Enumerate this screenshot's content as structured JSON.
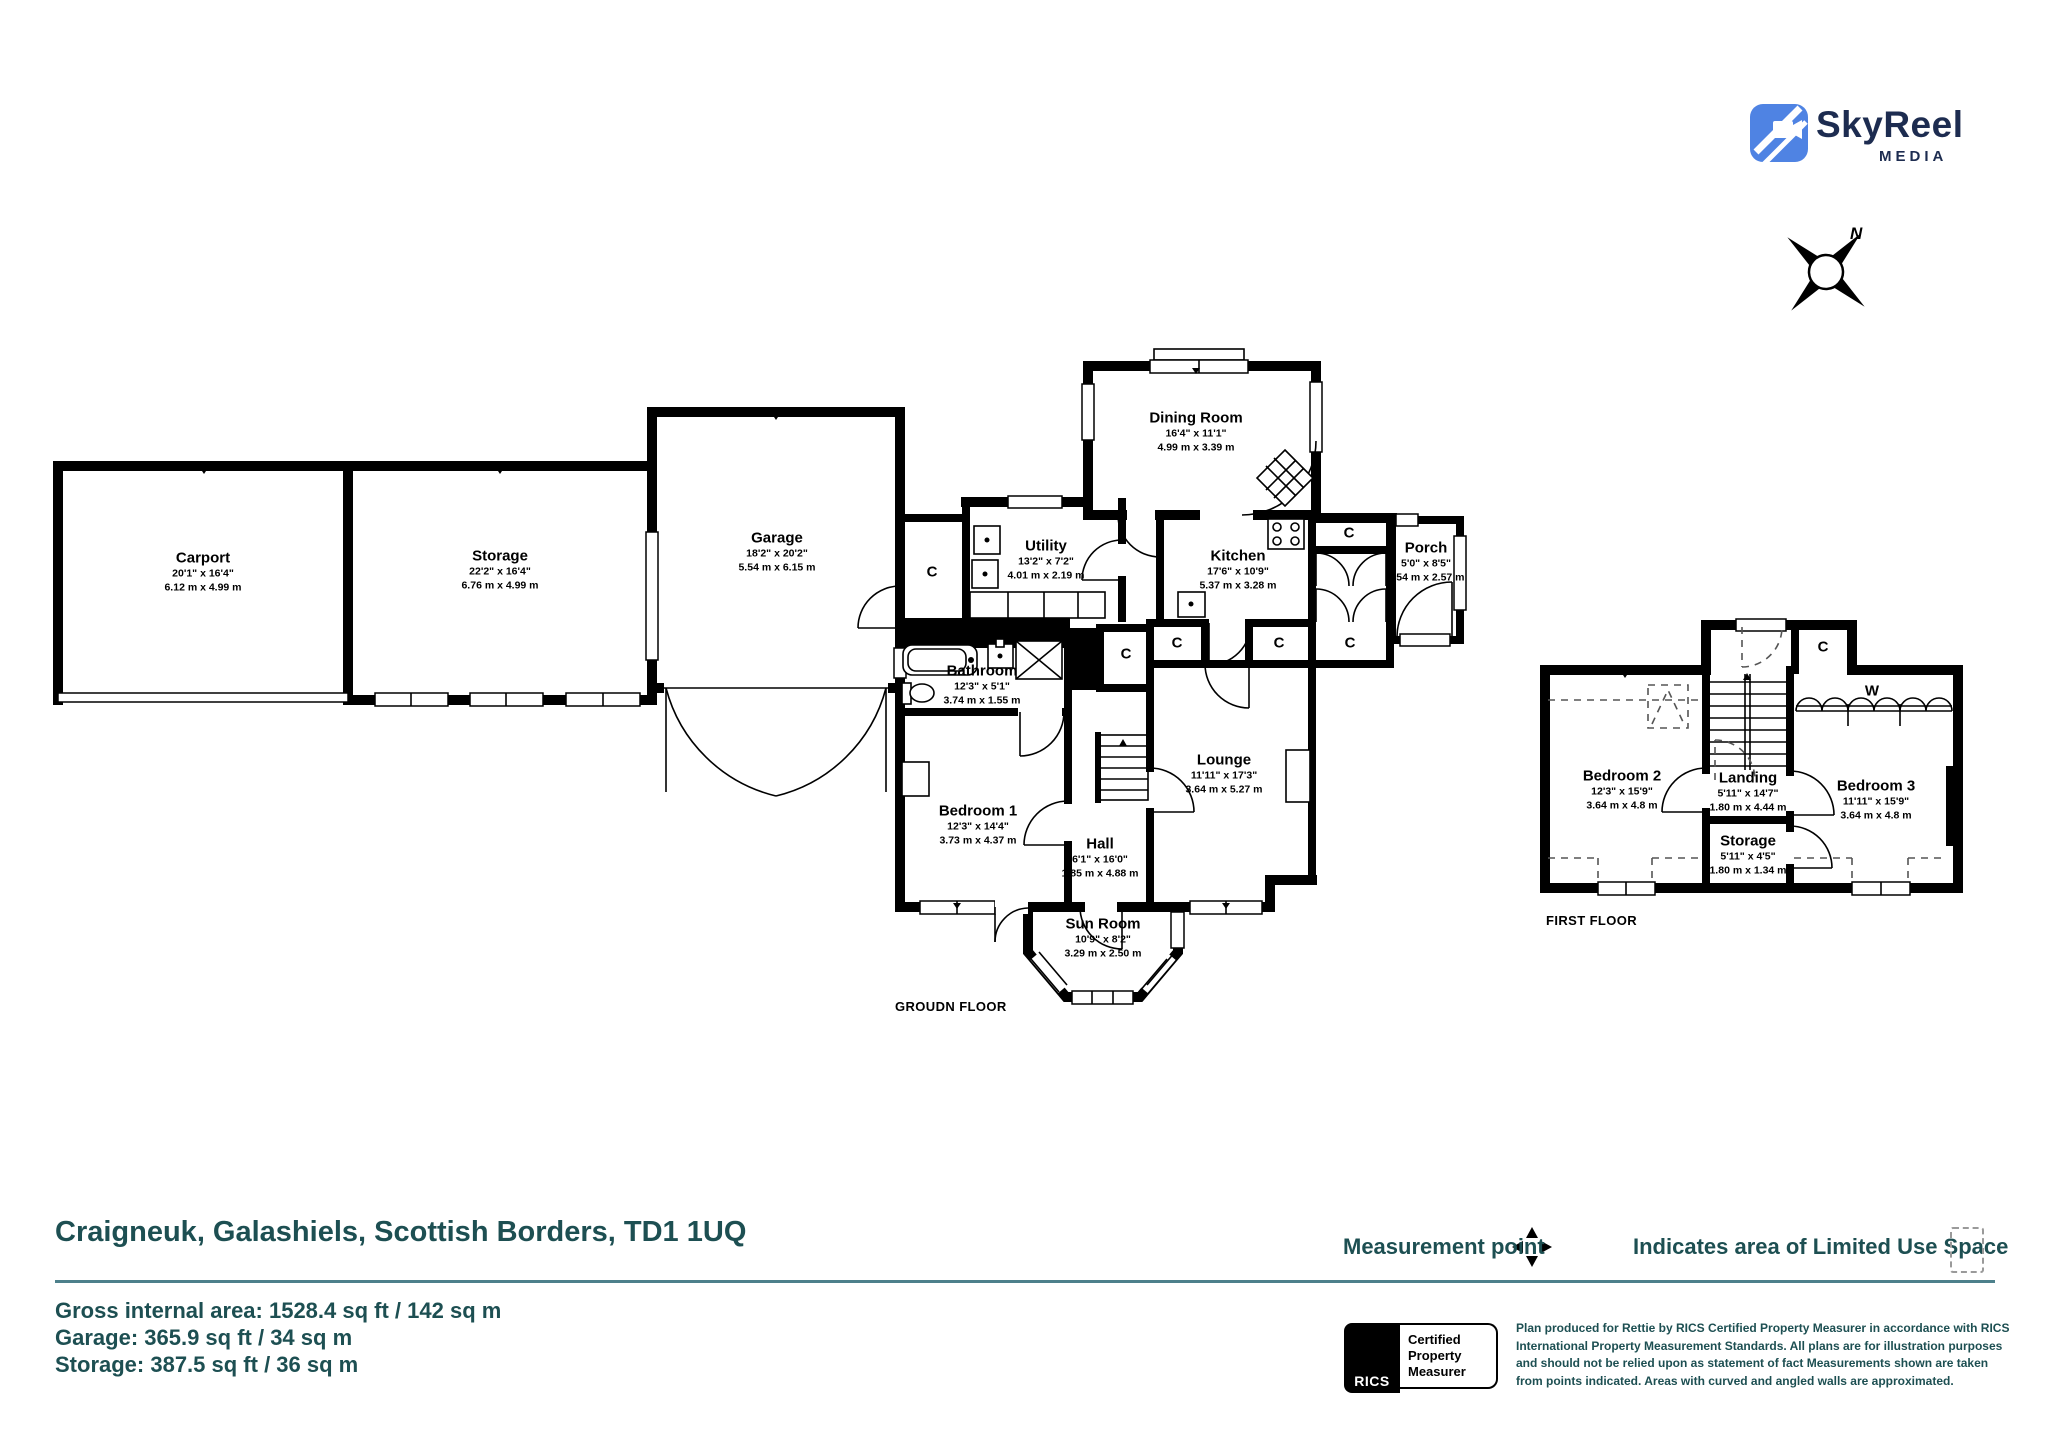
{
  "branding": {
    "logo_text": "SkyReel",
    "logo_subtext": "MEDIA",
    "logo_blue": "#4f83e3",
    "logo_navy": "#1d2c50"
  },
  "compass": {
    "north_label": "N"
  },
  "labels": {
    "closet": "C",
    "wardrobe": "W"
  },
  "floors": {
    "ground": {
      "title": "GROUDN FLOOR",
      "rooms": [
        {
          "name": "Carport",
          "imperial": "20'1\" x 16'4\"",
          "metric": "6.12 m x 4.99 m"
        },
        {
          "name": "Storage",
          "imperial": "22'2\" x 16'4\"",
          "metric": "6.76 m x 4.99 m"
        },
        {
          "name": "Garage",
          "imperial": "18'2\" x 20'2\"",
          "metric": "5.54 m x 6.15 m"
        },
        {
          "name": "Utility",
          "imperial": "13'2\" x 7'2\"",
          "metric": "4.01 m x 2.19 m"
        },
        {
          "name": "Dining Room",
          "imperial": "16'4\" x 11'1\"",
          "metric": "4.99 m x 3.39 m"
        },
        {
          "name": "Kitchen",
          "imperial": "17'6\" x 10'9\"",
          "metric": "5.37 m x 3.28 m"
        },
        {
          "name": "Porch",
          "imperial": "5'0\" x 8'5\"",
          "metric": "1.54 m x 2.57 m"
        },
        {
          "name": "Bathroom",
          "imperial": "12'3\" x 5'1\"",
          "metric": "3.74 m x 1.55 m"
        },
        {
          "name": "Bedroom 1",
          "imperial": "12'3\" x 14'4\"",
          "metric": "3.73 m x 4.37 m"
        },
        {
          "name": "Hall",
          "imperial": "6'1\" x 16'0\"",
          "metric": "1.85 m x 4.88 m"
        },
        {
          "name": "Lounge",
          "imperial": "11'11\" x 17'3\"",
          "metric": "3.64 m x 5.27 m"
        },
        {
          "name": "Sun Room",
          "imperial": "10'9\" x 8'2\"",
          "metric": "3.29 m x 2.50 m"
        }
      ]
    },
    "first": {
      "title": "FIRST FLOOR",
      "rooms": [
        {
          "name": "Bedroom 2",
          "imperial": "12'3\" x 15'9\"",
          "metric": "3.64 m x 4.8 m"
        },
        {
          "name": "Landing",
          "imperial": "5'11\" x 14'7\"",
          "metric": "1.80 m x 4.44 m"
        },
        {
          "name": "Bedroom 3",
          "imperial": "11'11\" x 15'9\"",
          "metric": "3.64 m x 4.8 m"
        },
        {
          "name": "Storage",
          "imperial": "5'11\" x 4'5\"",
          "metric": "1.80 m x 1.34 m"
        }
      ]
    }
  },
  "footer": {
    "address": "Craigneuk, Galashiels, Scottish Borders, TD1 1UQ",
    "legend": {
      "measurement_point": "Measurement point",
      "limited_use": "Indicates area of  Limited Use Space"
    },
    "areas": {
      "line1": "Gross internal area: 1528.4 sq ft / 142 sq m",
      "line2": "Garage: 365.9 sq ft / 34 sq m",
      "line3": "Storage: 387.5 sq ft / 36 sq m"
    },
    "rics": {
      "word": "RICS",
      "badge_line1": "Certified",
      "badge_line2": "Property",
      "badge_line3": "Measurer"
    },
    "disclaimer": "Plan produced for Rettie by RICS Certified Property Measurer in accordance with RICS International Property  Measurement Standards.  All plans are for illustration purposes and should not be relied upon as statement of fact Measurements shown are taken from points indicated. Areas with curved and angled walls are approximated.",
    "teal": "#1d4f52",
    "rule_color": "#4d808b"
  }
}
